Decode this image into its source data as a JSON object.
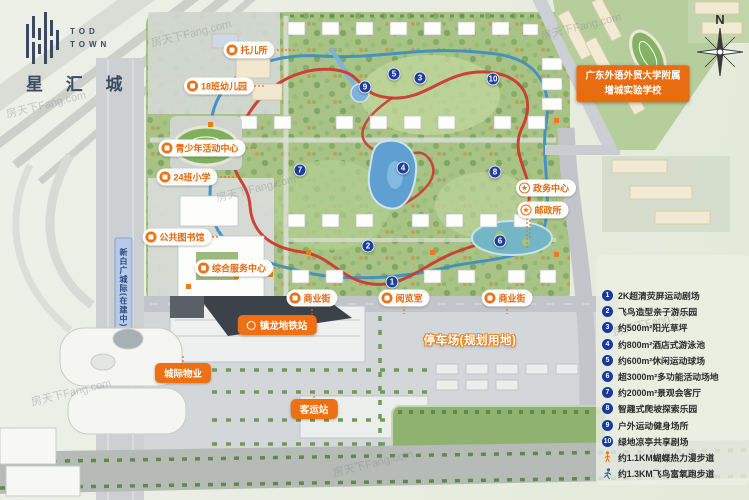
{
  "logo": {
    "tod": "TOD",
    "town": "TOWN",
    "name": "星 汇 城"
  },
  "compass_n": "N",
  "watermark": "房天下Fang.com",
  "rail_label": "新白广城际(在建中)",
  "school_label": {
    "line1": "广东外语外贸大学附属",
    "line2": "增城实验学校"
  },
  "parking_label": "停车场(规划用地)",
  "pills": [
    {
      "label": "托儿所",
      "icon": "building"
    },
    {
      "label": "18班幼儿园",
      "icon": "building"
    },
    {
      "label": "青少年活动中心",
      "icon": "building"
    },
    {
      "label": "24班小学",
      "icon": "school"
    },
    {
      "label": "公共图书馆",
      "icon": "book"
    },
    {
      "label": "综合服务中心",
      "icon": "building"
    },
    {
      "label": "商业街",
      "icon": "shop"
    },
    {
      "label": "阅览室",
      "icon": "book"
    },
    {
      "label": "商业街",
      "icon": "shop"
    },
    {
      "label": "政务中心",
      "icon": "star"
    },
    {
      "label": "邮政所",
      "icon": "star"
    },
    {
      "label": "镇龙地铁站",
      "icon": "metro"
    },
    {
      "label": "城际物业",
      "icon": "none"
    },
    {
      "label": "客运站",
      "icon": "none"
    }
  ],
  "markers": [
    "1",
    "2",
    "3",
    "4",
    "5",
    "6",
    "7",
    "8",
    "9",
    "10"
  ],
  "legend": {
    "items": [
      {
        "num": "1",
        "label": "2K超清荧屏运动剧场"
      },
      {
        "num": "2",
        "label": "飞鸟造型亲子游乐园"
      },
      {
        "num": "3",
        "label": "约500m²阳光草坪"
      },
      {
        "num": "4",
        "label": "约800m²酒店式游泳池"
      },
      {
        "num": "5",
        "label": "约600m²休闲运动球场"
      },
      {
        "num": "6",
        "label": "超3000m²多功能活动场地"
      },
      {
        "num": "7",
        "label": "约2000m²景观会客厅"
      },
      {
        "num": "8",
        "label": "智趣式爬坡探索乐园"
      },
      {
        "num": "9",
        "label": "户外运动健身场所"
      },
      {
        "num": "10",
        "label": "绿地凉亭共享剧场"
      }
    ],
    "trails": [
      {
        "label": "约1.1KM蝴蝶热力漫步道",
        "icon": "walking-person"
      },
      {
        "label": "约1.3KM飞鸟富氧跑步道",
        "icon": "running-person"
      }
    ]
  },
  "colors": {
    "accent_orange": "#ee7014",
    "track_red": "#cb3a30",
    "path_blue": "#3f8fc2",
    "marker_blue": "#1d3e9c",
    "logo_navy": "#3b4963"
  }
}
